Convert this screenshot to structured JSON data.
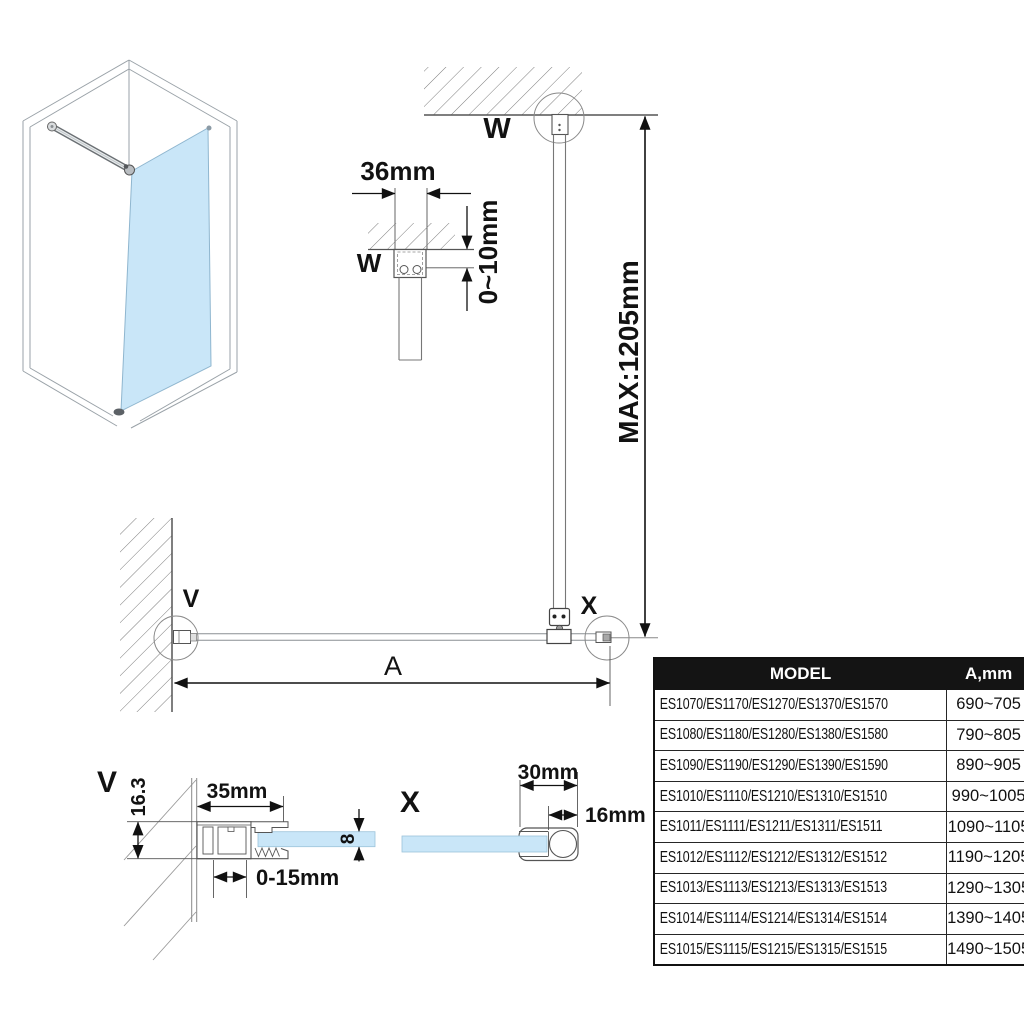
{
  "callouts": {
    "w": "W",
    "v": "V",
    "x": "X"
  },
  "dimensions": {
    "bracket_width": "36mm",
    "ceiling_gap": "0~10mm",
    "max_bar_length": "MAX:1205mm",
    "span_label": "A",
    "wall_profile_width": "35mm",
    "wall_profile_depth": "16.3",
    "glass_thickness": "8",
    "adjustment_range": "0-15mm",
    "clamp_width": "30mm",
    "bar_diameter": "16mm"
  },
  "table": {
    "headers": {
      "model": "MODEL",
      "a": "A,mm"
    },
    "rows": [
      {
        "model": "ES1070/ES1170/ES1270/ES1370/ES1570",
        "a": "690~705"
      },
      {
        "model": "ES1080/ES1180/ES1280/ES1380/ES1580",
        "a": "790~805"
      },
      {
        "model": "ES1090/ES1190/ES1290/ES1390/ES1590",
        "a": "890~905"
      },
      {
        "model": "ES1010/ES1110/ES1210/ES1310/ES1510",
        "a": "990~1005"
      },
      {
        "model": "ES1011/ES1111/ES1211/ES1311/ES1511",
        "a": "1090~1105"
      },
      {
        "model": "ES1012/ES1112/ES1212/ES1312/ES1512",
        "a": "1190~1205"
      },
      {
        "model": "ES1013/ES1113/ES1213/ES1313/ES1513",
        "a": "1290~1305"
      },
      {
        "model": "ES1014/ES1114/ES1214/ES1314/ES1514",
        "a": "1390~1405"
      },
      {
        "model": "ES1015/ES1115/ES1215/ES1315/ES1515",
        "a": "1490~1505"
      }
    ]
  },
  "colors": {
    "glass_blue": "#c9e6f8",
    "table_header_bg": "#141414",
    "table_header_text": "#ffffff",
    "dimension_ink": "#121212"
  }
}
